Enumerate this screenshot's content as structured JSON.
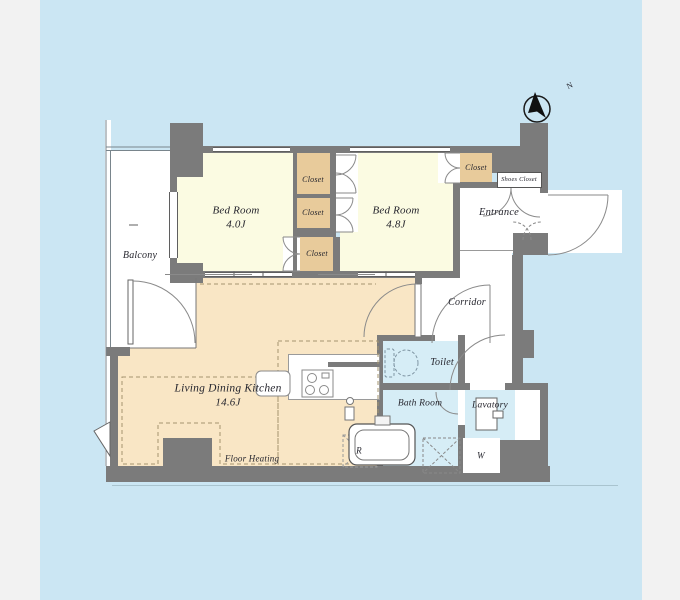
{
  "floorplan": {
    "compass_label": "N",
    "rooms": {
      "balcony": "Balcony",
      "bedroom_1": {
        "name": "Bed Room",
        "area": "4.0J"
      },
      "bedroom_2": {
        "name": "Bed Room",
        "area": "4.8J"
      },
      "living": {
        "name": "Living Dining Kitchen",
        "area": "14.6J"
      },
      "entrance": "Entrance",
      "corridor": "Corridor",
      "toilet": "Toilet",
      "bathroom": "Bath Room",
      "lavatory": "Lavatory"
    },
    "storage": {
      "closet_1": "Closet",
      "closet_2": "Closet",
      "closet_3": "Closet",
      "closet_4": "Closet",
      "shoes_closet": "Shoes Closet"
    },
    "annotations": {
      "floor_heating": "Floor Heating",
      "washer": "W",
      "refrigerator": "R"
    },
    "colors": {
      "canvas_blue": "#cbe6f3",
      "wall_gray": "#7b7b7b",
      "bedroom_yellow": "#fbfbe2",
      "ldk_tan": "#f9e6c5",
      "closet_tan": "#e8cb9b",
      "wet_room_blue": "#d6edf6",
      "page_margin_gray": "#f2f2f2"
    }
  }
}
